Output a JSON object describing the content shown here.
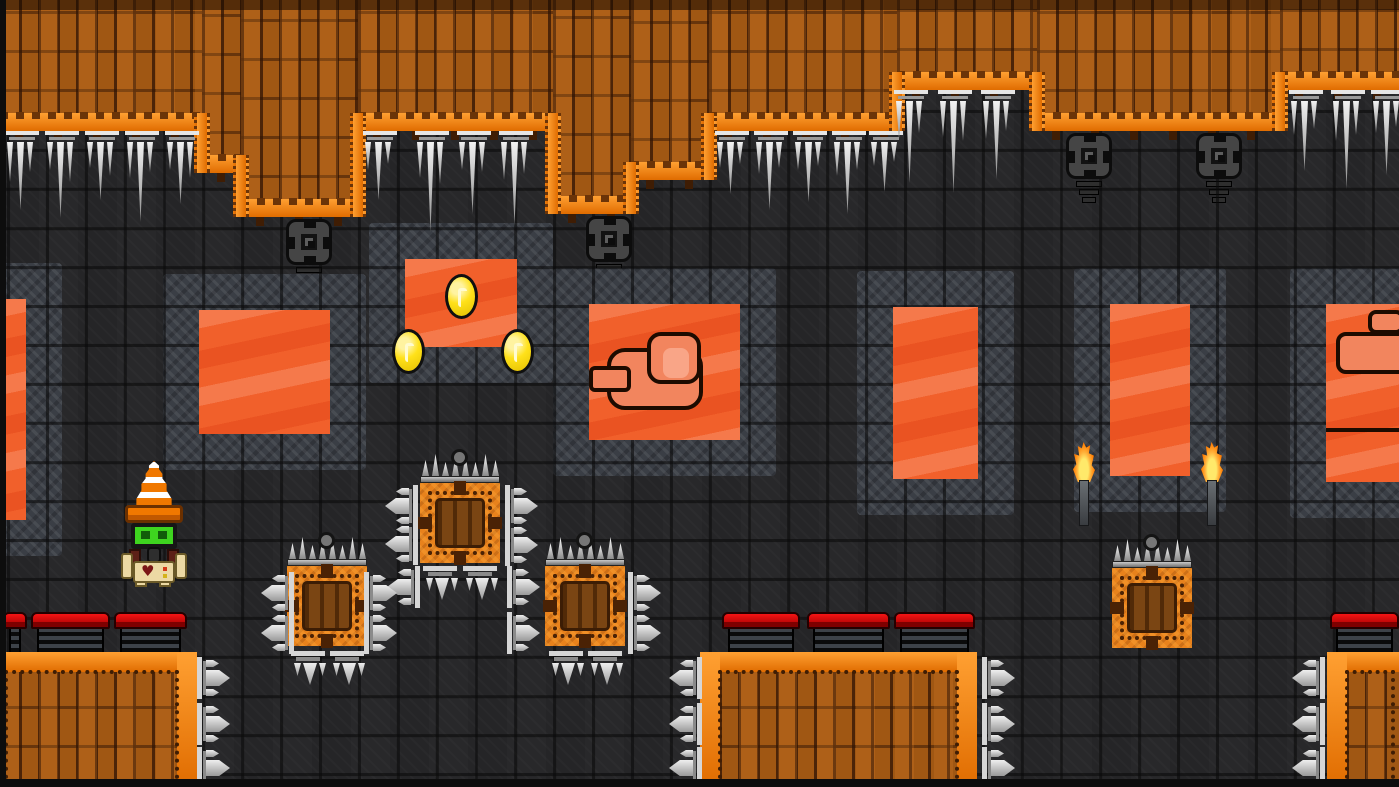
{
  "meta": {
    "description": "Pixel-art lava cavern platformer level scene, no HUD text visible",
    "viewport": {
      "width": 1399,
      "height": 787
    }
  },
  "palette": {
    "stone_background": "#28282a",
    "stone_grid_line": "#0a0a0a",
    "stone_frame_tile": "#3a3e45",
    "ceiling_dirt": "#a05713",
    "dirt_plank_gap": "#2f1304",
    "lava_trim_bright": "#ffa032",
    "lava_trim_deep": "#e06c00",
    "lava_window": "#f1602b",
    "lava_window_wave": "#f5794b",
    "lava_rock": "#f2855e",
    "coin_gold": "#ffe11a",
    "spike_metal": "#d6d6d6",
    "spike_block_orange": "#e8821c",
    "crate_brown": "#7a4513",
    "crusher_red": "#f51414",
    "torch_flame": "#ff7b00",
    "player_visor_green": "#3ed41f",
    "player_body_beige": "#ecd9a4",
    "player_cone_orange": "#f07800"
  },
  "scene": {
    "tile_size": 39,
    "grid_offset": {
      "x": 7,
      "y": 28
    },
    "ceiling_segments": [
      {
        "x": 0,
        "w": 202,
        "bottom": 131
      },
      {
        "x": 202,
        "w": 39,
        "bottom": 173
      },
      {
        "x": 241,
        "w": 117,
        "bottom": 217
      },
      {
        "x": 358,
        "w": 195,
        "bottom": 131
      },
      {
        "x": 553,
        "w": 78,
        "bottom": 214
      },
      {
        "x": 631,
        "w": 78,
        "bottom": 180
      },
      {
        "x": 709,
        "w": 188,
        "bottom": 131
      },
      {
        "x": 897,
        "w": 140,
        "bottom": 90
      },
      {
        "x": 1037,
        "w": 243,
        "bottom": 131
      },
      {
        "x": 1280,
        "w": 119,
        "bottom": 90
      }
    ],
    "icicle_clusters": [
      {
        "x": 4,
        "y": 131,
        "heights": [
          40,
          68,
          30
        ]
      },
      {
        "x": 44,
        "y": 131,
        "heights": [
          28,
          76,
          40
        ]
      },
      {
        "x": 84,
        "y": 131,
        "heights": [
          26,
          58,
          34
        ]
      },
      {
        "x": 124,
        "y": 131,
        "heights": [
          36,
          80,
          30
        ]
      },
      {
        "x": 164,
        "y": 131,
        "heights": [
          28,
          62,
          36
        ]
      },
      {
        "x": 362,
        "y": 131,
        "heights": [
          28,
          58,
          22
        ]
      },
      {
        "x": 414,
        "y": 131,
        "heights": [
          36,
          90,
          42
        ]
      },
      {
        "x": 456,
        "y": 131,
        "heights": [
          28,
          72,
          30
        ]
      },
      {
        "x": 498,
        "y": 131,
        "heights": [
          38,
          84,
          32
        ]
      },
      {
        "x": 714,
        "y": 131,
        "heights": [
          26,
          52,
          22
        ]
      },
      {
        "x": 753,
        "y": 131,
        "heights": [
          32,
          68,
          26
        ]
      },
      {
        "x": 792,
        "y": 131,
        "heights": [
          28,
          60,
          24
        ]
      },
      {
        "x": 831,
        "y": 131,
        "heights": [
          34,
          72,
          28
        ]
      },
      {
        "x": 868,
        "y": 131,
        "heights": [
          24,
          50,
          20
        ]
      },
      {
        "x": 893,
        "y": 90,
        "heights": [
          38,
          82,
          32
        ]
      },
      {
        "x": 937,
        "y": 90,
        "heights": [
          36,
          92,
          40
        ]
      },
      {
        "x": 980,
        "y": 90,
        "heights": [
          38,
          78,
          30
        ]
      },
      {
        "x": 1288,
        "y": 90,
        "heights": [
          34,
          70,
          28
        ]
      },
      {
        "x": 1330,
        "y": 90,
        "heights": [
          40,
          88,
          34
        ]
      },
      {
        "x": 1370,
        "y": 90,
        "heights": [
          32,
          74,
          26
        ]
      }
    ],
    "turrets": [
      {
        "x": 286,
        "y": 219
      },
      {
        "x": 586,
        "y": 216
      },
      {
        "x": 1066,
        "y": 133
      },
      {
        "x": 1196,
        "y": 133
      }
    ],
    "windows": [
      {
        "x": 0,
        "y": 299,
        "w": 26,
        "h": 221,
        "variant": "plain",
        "frame": true
      },
      {
        "x": 199,
        "y": 310,
        "w": 131,
        "h": 124,
        "variant": "plain",
        "frame": true
      },
      {
        "x": 405,
        "y": 259,
        "w": 112,
        "h": 88,
        "variant": "plain",
        "frame": true
      },
      {
        "x": 589,
        "y": 304,
        "w": 151,
        "h": 136,
        "variant": "fist",
        "frame": true
      },
      {
        "x": 893,
        "y": 307,
        "w": 85,
        "h": 172,
        "variant": "plain",
        "frame": true
      },
      {
        "x": 1110,
        "y": 304,
        "w": 80,
        "h": 172,
        "variant": "plain",
        "frame": true
      },
      {
        "x": 1326,
        "y": 304,
        "w": 73,
        "h": 178,
        "variant": "rocks",
        "frame": true
      }
    ],
    "coins": [
      {
        "x": 445,
        "y": 274
      },
      {
        "x": 392,
        "y": 329
      },
      {
        "x": 501,
        "y": 329
      }
    ],
    "player": {
      "x": 121,
      "y": 461,
      "heart_glyph": "♥"
    },
    "spike_blocks": [
      {
        "x": 420,
        "y": 483
      },
      {
        "x": 287,
        "y": 566
      },
      {
        "x": 545,
        "y": 566
      },
      {
        "x": 1112,
        "y": 568
      }
    ],
    "spike_side_launchers": [
      {
        "x": 384,
        "y": 483,
        "dir": "left"
      },
      {
        "x": 384,
        "y": 521,
        "dir": "left"
      },
      {
        "x": 386,
        "y": 564,
        "dir": "left"
      },
      {
        "x": 505,
        "y": 483,
        "dir": "right"
      },
      {
        "x": 505,
        "y": 522,
        "dir": "right"
      },
      {
        "x": 507,
        "y": 564,
        "dir": "right"
      },
      {
        "x": 507,
        "y": 610,
        "dir": "right"
      },
      {
        "x": 628,
        "y": 570,
        "dir": "right"
      },
      {
        "x": 628,
        "y": 610,
        "dir": "right"
      },
      {
        "x": 260,
        "y": 570,
        "dir": "left"
      },
      {
        "x": 260,
        "y": 610,
        "dir": "left"
      },
      {
        "x": 364,
        "y": 570,
        "dir": "right"
      },
      {
        "x": 364,
        "y": 610,
        "dir": "right"
      },
      {
        "x": 197,
        "y": 655,
        "dir": "right"
      },
      {
        "x": 197,
        "y": 701,
        "dir": "right"
      },
      {
        "x": 197,
        "y": 745,
        "dir": "right"
      },
      {
        "x": 668,
        "y": 655,
        "dir": "left"
      },
      {
        "x": 668,
        "y": 701,
        "dir": "left"
      },
      {
        "x": 668,
        "y": 745,
        "dir": "left"
      },
      {
        "x": 982,
        "y": 655,
        "dir": "right"
      },
      {
        "x": 982,
        "y": 701,
        "dir": "right"
      },
      {
        "x": 982,
        "y": 745,
        "dir": "right"
      },
      {
        "x": 1291,
        "y": 655,
        "dir": "left"
      },
      {
        "x": 1291,
        "y": 701,
        "dir": "left"
      },
      {
        "x": 1291,
        "y": 745,
        "dir": "left"
      }
    ],
    "spike_down_launchers": [
      {
        "x": 421,
        "y": 566
      },
      {
        "x": 461,
        "y": 566
      },
      {
        "x": 547,
        "y": 651
      },
      {
        "x": 586,
        "y": 651
      },
      {
        "x": 289,
        "y": 651
      },
      {
        "x": 328,
        "y": 651
      }
    ],
    "torches": [
      {
        "x": 1072,
        "y": 442
      },
      {
        "x": 1200,
        "y": 442
      }
    ],
    "dirt_blocks": [
      {
        "x": 0,
        "y": 652,
        "w": 197,
        "h": 135,
        "trims": [
          "top",
          "right"
        ]
      },
      {
        "x": 700,
        "y": 652,
        "w": 277,
        "h": 135,
        "trims": [
          "top",
          "left",
          "right"
        ]
      },
      {
        "x": 1327,
        "y": 652,
        "w": 72,
        "h": 135,
        "trims": [
          "top",
          "left"
        ]
      }
    ],
    "crushers": [
      {
        "x": 3,
        "y": 612,
        "w": 24
      },
      {
        "x": 31,
        "y": 612,
        "w": 79
      },
      {
        "x": 114,
        "y": 612,
        "w": 73
      },
      {
        "x": 722,
        "y": 612,
        "w": 78
      },
      {
        "x": 807,
        "y": 612,
        "w": 83
      },
      {
        "x": 894,
        "y": 612,
        "w": 81
      },
      {
        "x": 1330,
        "y": 612,
        "w": 69
      }
    ]
  }
}
